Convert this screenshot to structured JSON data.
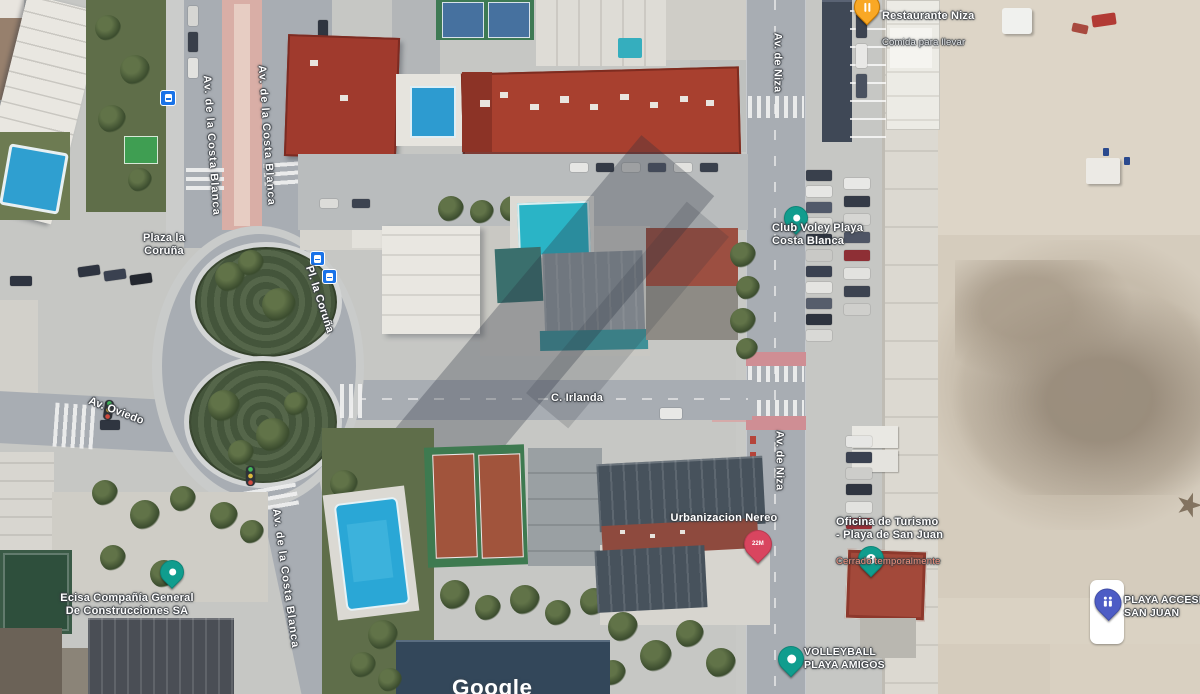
{
  "road_labels": {
    "av_costa_blanca_n1": "Av. de la Costa Blanca",
    "av_costa_blanca_n2": "Av. de la Costa Blanca",
    "av_costa_blanca_s": "Av. de la Costa Blanca",
    "pl_la_coruna": "Pl. la Coruña",
    "av_oviedo": "Av. Oviedo",
    "c_irlanda": "C. Irlanda",
    "av_niza_n": "Av. de Niza",
    "av_niza_s": "Av. de Niza"
  },
  "area_labels": {
    "plaza_la_coruna": "Plaza la\nCoruña"
  },
  "places": {
    "restaurante_niza": {
      "name": "Restaurante Niza",
      "detail": "Comida para llevar"
    },
    "club_voley": {
      "name": "Club Voley Playa\nCosta Blanca"
    },
    "urbanizacion_nereo": {
      "name": "Urbanizacion Nereo",
      "pin_badge": "22M"
    },
    "oficina_turismo": {
      "name": "Oficina de Turismo\n- Playa de San Juan",
      "status": "Cerrado temporalmente"
    },
    "ecisa": {
      "name": "Ecisa Compañía General\nDe Construcciones SA"
    },
    "volleyball_playa_amigos": {
      "name": "VOLLEYBALL\nPLAYA AMIGOS"
    },
    "playa_accesible_san_juan": {
      "name": "PLAYA ACCESI\nSAN JUAN"
    }
  },
  "watermark": {
    "text": "Google"
  },
  "colors": {
    "poi_pin_teal": "#109d8e",
    "restaurant_pin_orange": "#f9a825",
    "marker_crimson": "#d9455f",
    "accessible_pin_blue": "#4d5cc5",
    "bus_icon_blue": "#1a73e8",
    "closed_status_red": "#f5937e",
    "label_text": "#ffffff",
    "road_gray": "#a8adb3",
    "beach_sand": "#d5ccbd"
  }
}
